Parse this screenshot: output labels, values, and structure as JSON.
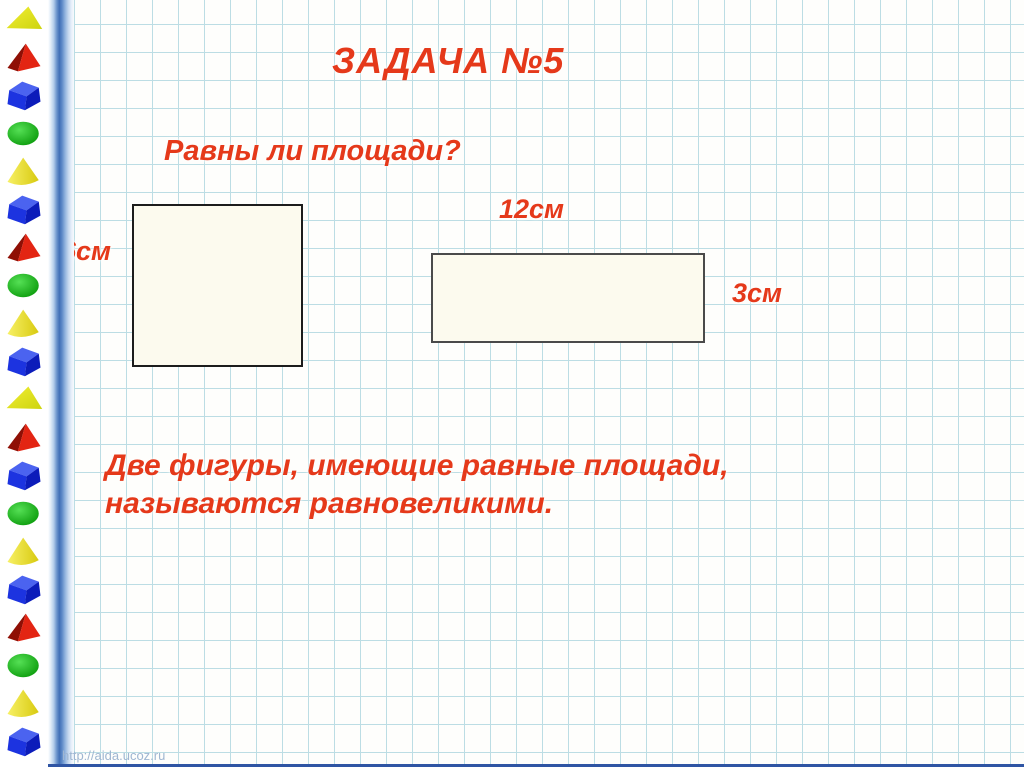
{
  "slide": {
    "title": "ЗАДАЧА №5",
    "question": "Равны ли площади?",
    "definition_line1": "Две фигуры, имеющие равные площади,",
    "definition_line2": "называются равновеликими.",
    "watermark": "http://aida.ucoz.ru"
  },
  "figures": {
    "square": {
      "side_label": "6см"
    },
    "rectangle": {
      "width_label": "12см",
      "height_label": "3см"
    }
  },
  "sidebar": {
    "shapes": [
      "yellow-triangle",
      "red-pyramid",
      "blue-cube",
      "green-ellipse",
      "yellow-cone",
      "blue-cube",
      "red-pyramid",
      "green-ellipse",
      "yellow-cone",
      "blue-cube",
      "yellow-triangle",
      "red-pyramid",
      "blue-cube",
      "green-ellipse",
      "yellow-cone",
      "blue-cube",
      "red-pyramid",
      "green-ellipse",
      "yellow-cone",
      "blue-cube"
    ]
  },
  "colors": {
    "text_red": "#e5391a",
    "grid_line": "#bcdde4",
    "figure_fill": "#fcfaee",
    "bottom_bar": "#2f55a4",
    "cube_blue": "#1c33e0",
    "pyramid_red": "#e32513",
    "ellipse_green": "#18b418",
    "cone_yellow": "#e8de2e"
  }
}
